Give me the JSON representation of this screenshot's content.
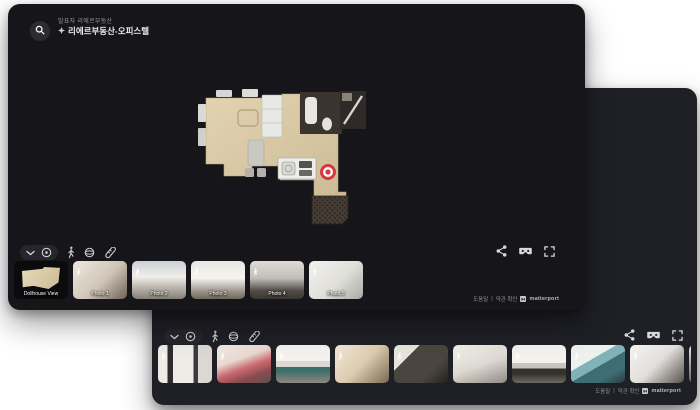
{
  "colors": {
    "marker_red": "#d63a3f",
    "front_window_bg": "#15151a",
    "back_window_bg": "#1f2026"
  },
  "front_window": {
    "header": {
      "presenter": "발표자 리에르부동산",
      "title": "리에르부동산-오피스텔",
      "search_icon": "magnifier",
      "pin_icon": "space-pin"
    },
    "toolbar": {
      "left_icons": [
        "chevron-down",
        "views",
        "walk",
        "dollhouse-view",
        "measure"
      ],
      "right_icons": [
        "share",
        "vr-headset",
        "fullscreen"
      ]
    },
    "thumbnails": [
      {
        "label": "Dollhouse View",
        "kind": "dollhouse"
      },
      {
        "label": "Photo 1",
        "kind": "photo"
      },
      {
        "label": "Photo 2",
        "kind": "photo"
      },
      {
        "label": "Photo 3",
        "kind": "photo"
      },
      {
        "label": "Photo 4",
        "kind": "photo"
      },
      {
        "label": "Photo 5",
        "kind": "photo"
      }
    ],
    "footer": {
      "help": "도움말",
      "divider": "|",
      "terms": "약관 확인",
      "brand": "matterport"
    }
  },
  "back_window": {
    "toolbar": {
      "left_icons": [
        "chevron-down",
        "views",
        "walk",
        "dollhouse-view",
        "measure"
      ],
      "right_icons": [
        "share",
        "vr-headset",
        "fullscreen"
      ]
    },
    "thumbnail_count": 10,
    "footer": {
      "help": "도움말",
      "divider": "|",
      "terms": "약관 확인",
      "brand": "matterport"
    }
  }
}
